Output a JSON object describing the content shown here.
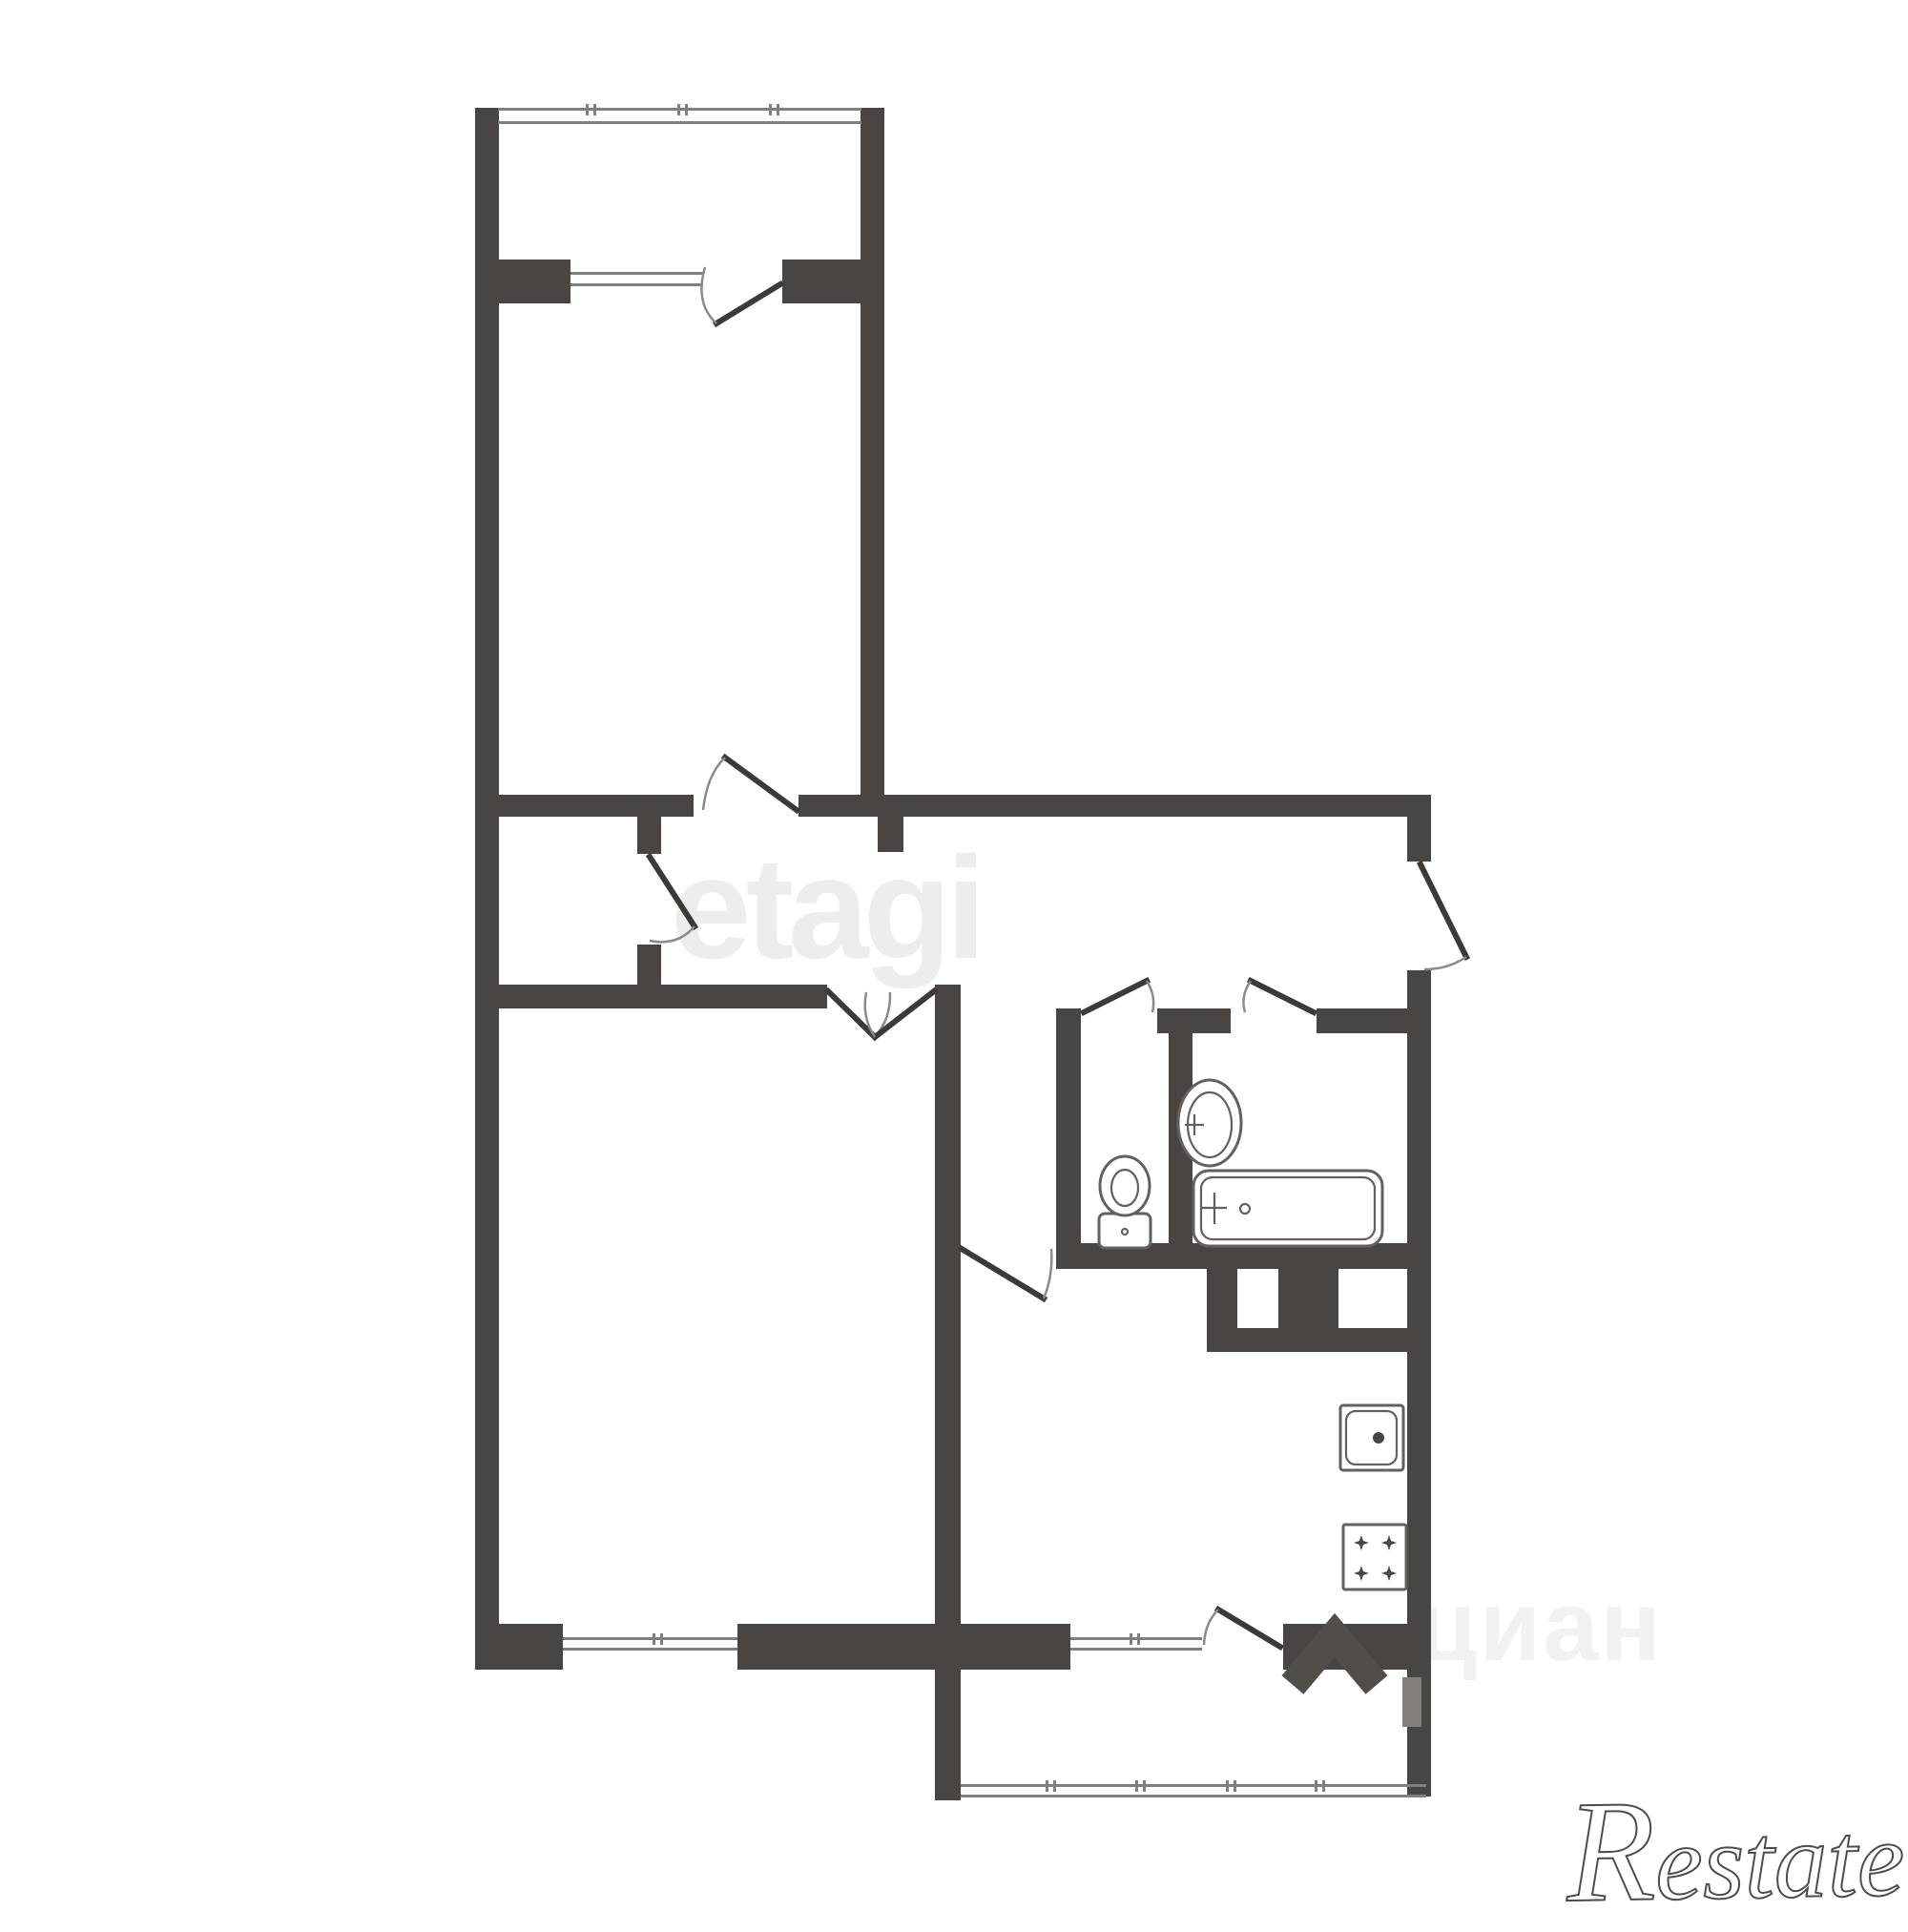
{
  "watermarks": {
    "etagi": "etagi",
    "cian": "циан",
    "restate_initial": "R",
    "restate_rest": "estate"
  },
  "colors": {
    "background": "#ffffff",
    "wall": "#494542",
    "door_leaf": "#3c3936",
    "door_arc": "#8a8a88",
    "window_line": "#7f7f7d",
    "fixture_outline": "#63615e",
    "watermark_etagi": "#ededeb",
    "watermark_cian_text": "#f1f1ef",
    "watermark_cian_mark": "#514d49",
    "cian_wall_light": "#83807c",
    "restate_outline": "#4c4c4c"
  },
  "icons": {
    "fixtures": [
      "toilet-icon",
      "bathroom-sink-icon",
      "bathtub-icon",
      "kitchen-sink-icon",
      "stove-burners-icon"
    ],
    "doors": [
      "door-swing-icon"
    ],
    "windows": [
      "window-glazing-icon",
      "balcony-glazing-icon"
    ],
    "brand_marks": [
      "cian-roof-icon"
    ]
  }
}
